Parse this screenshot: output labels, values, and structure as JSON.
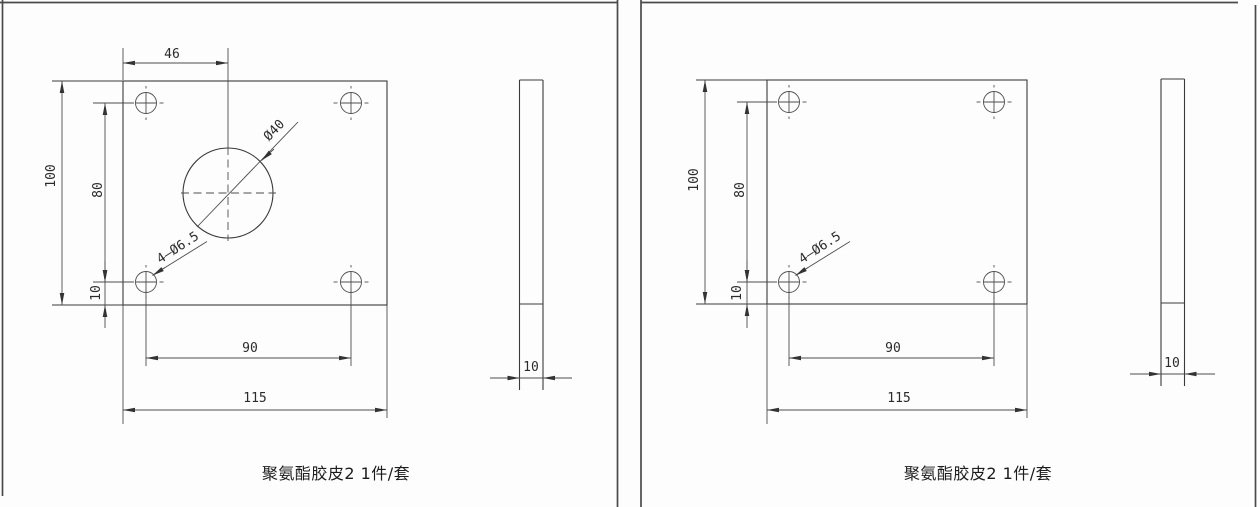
{
  "sheet": {
    "panels": [
      {
        "caption": "聚氨酯胶皮2 1件/套",
        "front_view": {
          "dim_hole_offset_x": "46",
          "dim_height": "100",
          "dim_hole_span_y": "80",
          "dim_bottom_margin": "10",
          "dim_hole_span_x": "90",
          "dim_width": "115",
          "label_center_hole": "Ø40",
          "label_holes": "4—Ø6.5"
        },
        "side_view": {
          "dim_thickness": "10"
        }
      },
      {
        "caption": "聚氨酯胶皮2 1件/套",
        "front_view": {
          "dim_height": "100",
          "dim_hole_span_y": "80",
          "dim_bottom_margin": "10",
          "dim_hole_span_x": "90",
          "dim_width": "115",
          "label_holes": "4—Ø6.5"
        },
        "side_view": {
          "dim_thickness": "10"
        }
      }
    ]
  }
}
